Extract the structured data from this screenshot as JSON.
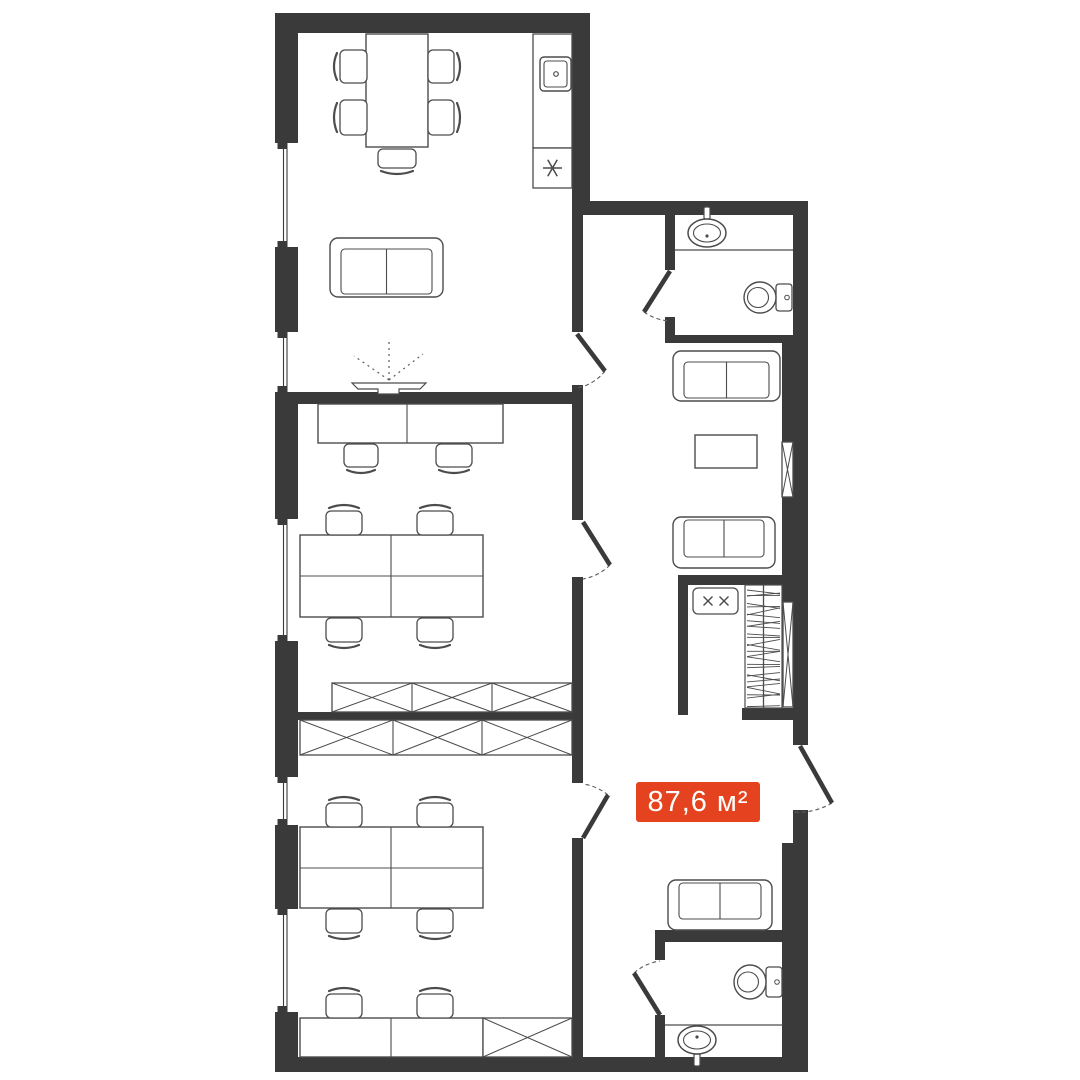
{
  "floorplan": {
    "area_label": "87,6 м²",
    "colors": {
      "wall": "#3a3a3a",
      "outline": "#4c4c4c",
      "outline_light": "#5c5c5c",
      "accent": "#e5431f",
      "label_text": "#ffffff",
      "background": "#ffffff"
    },
    "rooms": [
      {
        "name": "living-kitchen",
        "furniture": [
          "dining-table",
          "dining-chair",
          "dining-chair",
          "dining-chair",
          "dining-chair",
          "dining-chair",
          "kitchen-counter",
          "kitchen-sink",
          "stove",
          "sofa",
          "ceiling-light"
        ]
      },
      {
        "name": "office-1",
        "furniture": [
          "wall-desk",
          "office-chair",
          "office-chair",
          "meeting-table",
          "office-chair",
          "office-chair",
          "office-chair",
          "office-chair",
          "wardrobe"
        ]
      },
      {
        "name": "office-2",
        "furniture": [
          "wardrobe",
          "meeting-table",
          "office-chair",
          "office-chair",
          "office-chair",
          "office-chair",
          "wall-desk",
          "office-chair",
          "office-chair",
          "cabinet"
        ]
      },
      {
        "name": "hallway-lounge",
        "furniture": [
          "sofa",
          "coffee-table",
          "sofa",
          "sofa",
          "vent-shaft",
          "vent-shaft"
        ]
      },
      {
        "name": "walk-in-closet",
        "furniture": [
          "shoe-cabinet",
          "clothes-rail"
        ]
      },
      {
        "name": "bathroom-1",
        "furniture": [
          "washbasin",
          "toilet"
        ]
      },
      {
        "name": "bathroom-2",
        "furniture": [
          "washbasin",
          "toilet"
        ]
      }
    ],
    "openings": [
      "entrance-door",
      "living-room-door",
      "office-1-door",
      "office-2-door",
      "bathroom-1-door",
      "bathroom-2-door"
    ],
    "window_count": 5
  }
}
